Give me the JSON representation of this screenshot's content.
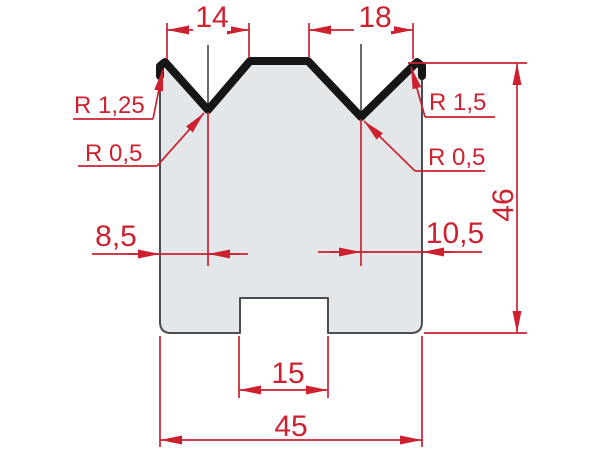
{
  "drawing": {
    "description_visible_text_only": "2V press-brake die cross-section with red dimensioning",
    "dims": {
      "top_left_v_width": "14",
      "top_right_v_width": "18",
      "radius_top_left": "R 1,25",
      "radius_groove_left": "R 0,5",
      "radius_top_right": "R 1,5",
      "radius_groove_right": "R 0,5",
      "offset_left": "8,5",
      "offset_right": "10,5",
      "height": "46",
      "slot_width": "15",
      "total_width": "45"
    },
    "colors": {
      "dimension_red": "#cd2130",
      "die_fill": "#e4e7ea",
      "die_edge": "#4a4e53",
      "profile_black": "#161616",
      "background": "#ffffff"
    }
  }
}
